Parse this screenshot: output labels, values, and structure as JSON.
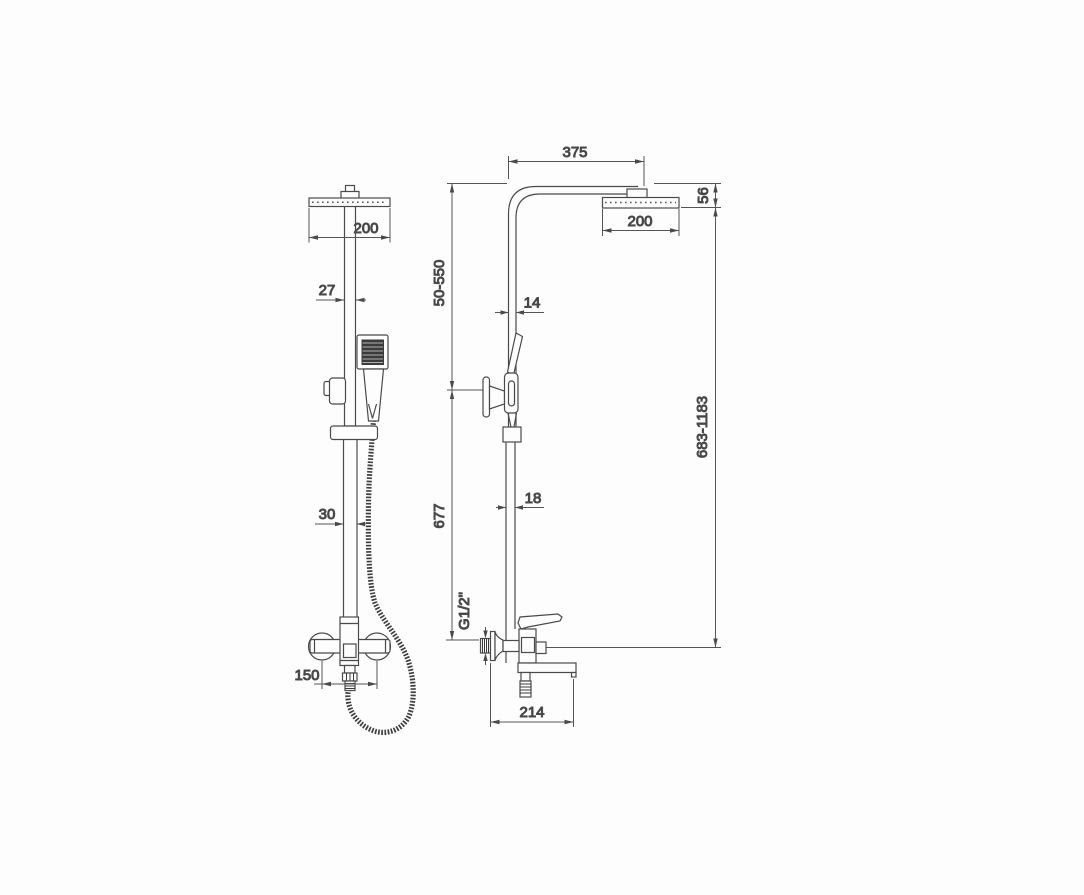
{
  "page": {
    "background": "#fdfdfd",
    "line_color": "#4a4a4a",
    "description": "Technical dimension drawing of a shower column system, front view and side view"
  },
  "front_view": {
    "head_width": "200",
    "column_width": "27",
    "lower_column_width": "30",
    "wall_mount_spacing": "150"
  },
  "side_view": {
    "arm_reach": "375",
    "head_depth": "200",
    "head_height": "56",
    "upper_adjust_range": "50-550",
    "upper_pipe_depth": "14",
    "lower_pipe_depth": "18",
    "lower_column_length": "677",
    "overall_height_range": "683-1183",
    "connection_thread": "G1/2\"",
    "spout_reach": "214"
  }
}
